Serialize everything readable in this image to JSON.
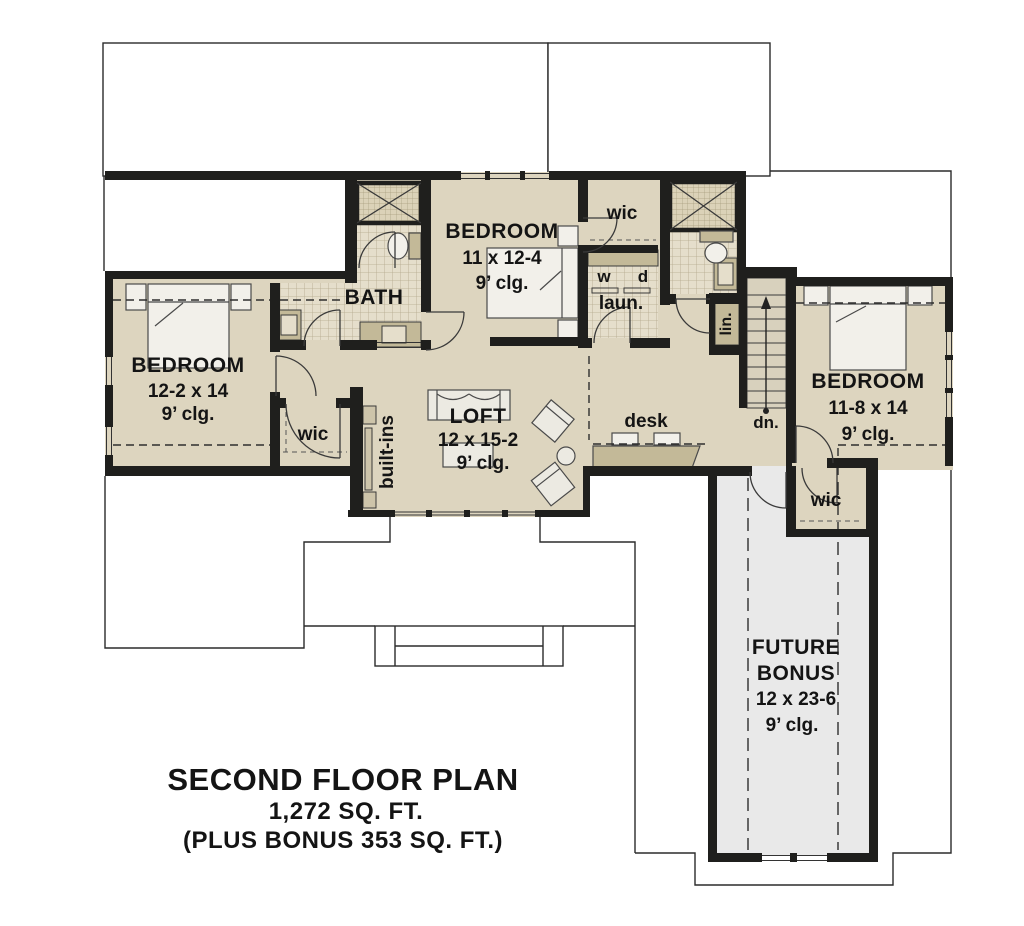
{
  "plan": {
    "rooms": {
      "bedroom_left": {
        "name": "BEDROOM",
        "dims": "12-2 x 14",
        "ceiling": "9’ clg."
      },
      "bedroom_middle": {
        "name": "BEDROOM",
        "dims": "11 x 12-4",
        "ceiling": "9’ clg."
      },
      "bedroom_right": {
        "name": "BEDROOM",
        "dims": "11-8 x 14",
        "ceiling": "9’ clg."
      },
      "loft": {
        "name": "LOFT",
        "dims": "12 x 15-2",
        "ceiling": "9’ clg."
      },
      "future_bonus": {
        "name_line1": "FUTURE",
        "name_line2": "BONUS",
        "dims": "12 x 23-6",
        "ceiling": "9’ clg."
      },
      "bath": {
        "name": "BATH"
      },
      "wic_middle": {
        "name": "wic"
      },
      "wic_left": {
        "name": "wic"
      },
      "wic_right": {
        "name": "wic"
      },
      "laundry": {
        "washer": "w",
        "dryer": "d",
        "name": "laun."
      },
      "linen": {
        "name": "lin."
      },
      "built_ins": {
        "name": "built-ins"
      },
      "desk": {
        "name": "desk"
      },
      "stairs": {
        "name": "dn."
      }
    },
    "title": {
      "line1": "SECOND FLOOR PLAN",
      "line2": "1,272  SQ. FT.",
      "line3": "(PLUS BONUS 353 SQ. FT.)"
    },
    "colors": {
      "floor_tan": "#ddd5bf",
      "tile": "#e5decb",
      "cabinet_tan": "#c3b998",
      "bonus_gray": "#e9e9e9",
      "wall": "#1f1f1d",
      "stair_fill": "#d8d1bd"
    }
  }
}
